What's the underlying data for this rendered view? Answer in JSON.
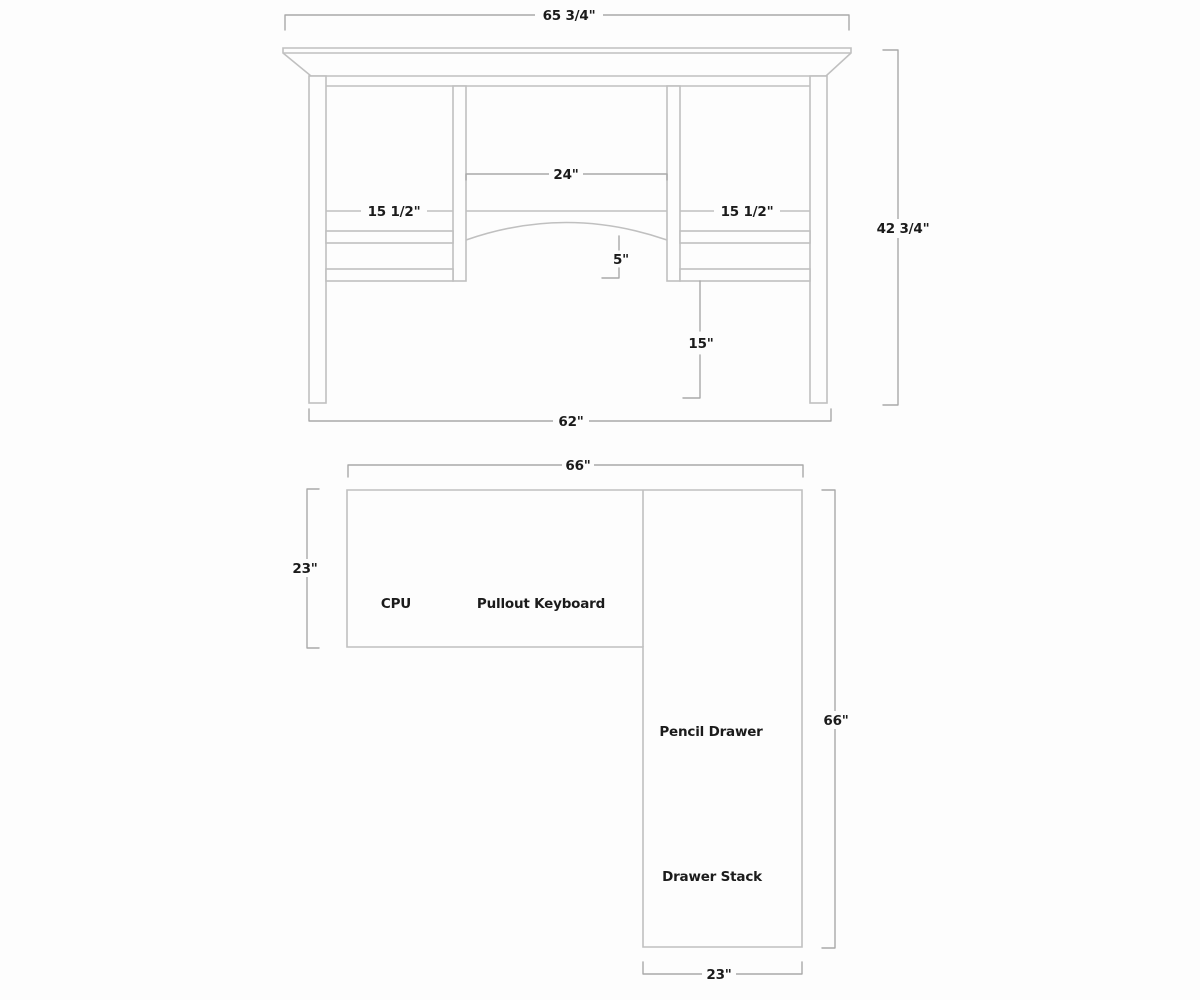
{
  "title": "Desk construction drawing",
  "colors": {
    "structure_line": "#c0c0c0",
    "dimension_line": "#a9a9a9",
    "text": "#1b1b1b",
    "background": "#fdfdfd"
  },
  "front_elevation": {
    "dim_overall_width": "65 3/4\"",
    "dim_overall_height": "42 3/4\"",
    "dim_center_opening": "24\"",
    "dim_left_opening": "15 1/2\"",
    "dim_right_opening": "15 1/2\"",
    "dim_arch_rise": "5\"",
    "dim_knee_clearance": "15\"",
    "dim_leg_span": "62\""
  },
  "plan_view": {
    "dim_desk_length": "66\"",
    "dim_desk_depth": "23\"",
    "dim_return_length": "66\"",
    "dim_return_depth": "23\"",
    "label_cpu": "CPU",
    "label_pullout_keyboard": "Pullout Keyboard",
    "label_pencil_drawer": "Pencil Drawer",
    "label_drawer_stack": "Drawer Stack"
  }
}
